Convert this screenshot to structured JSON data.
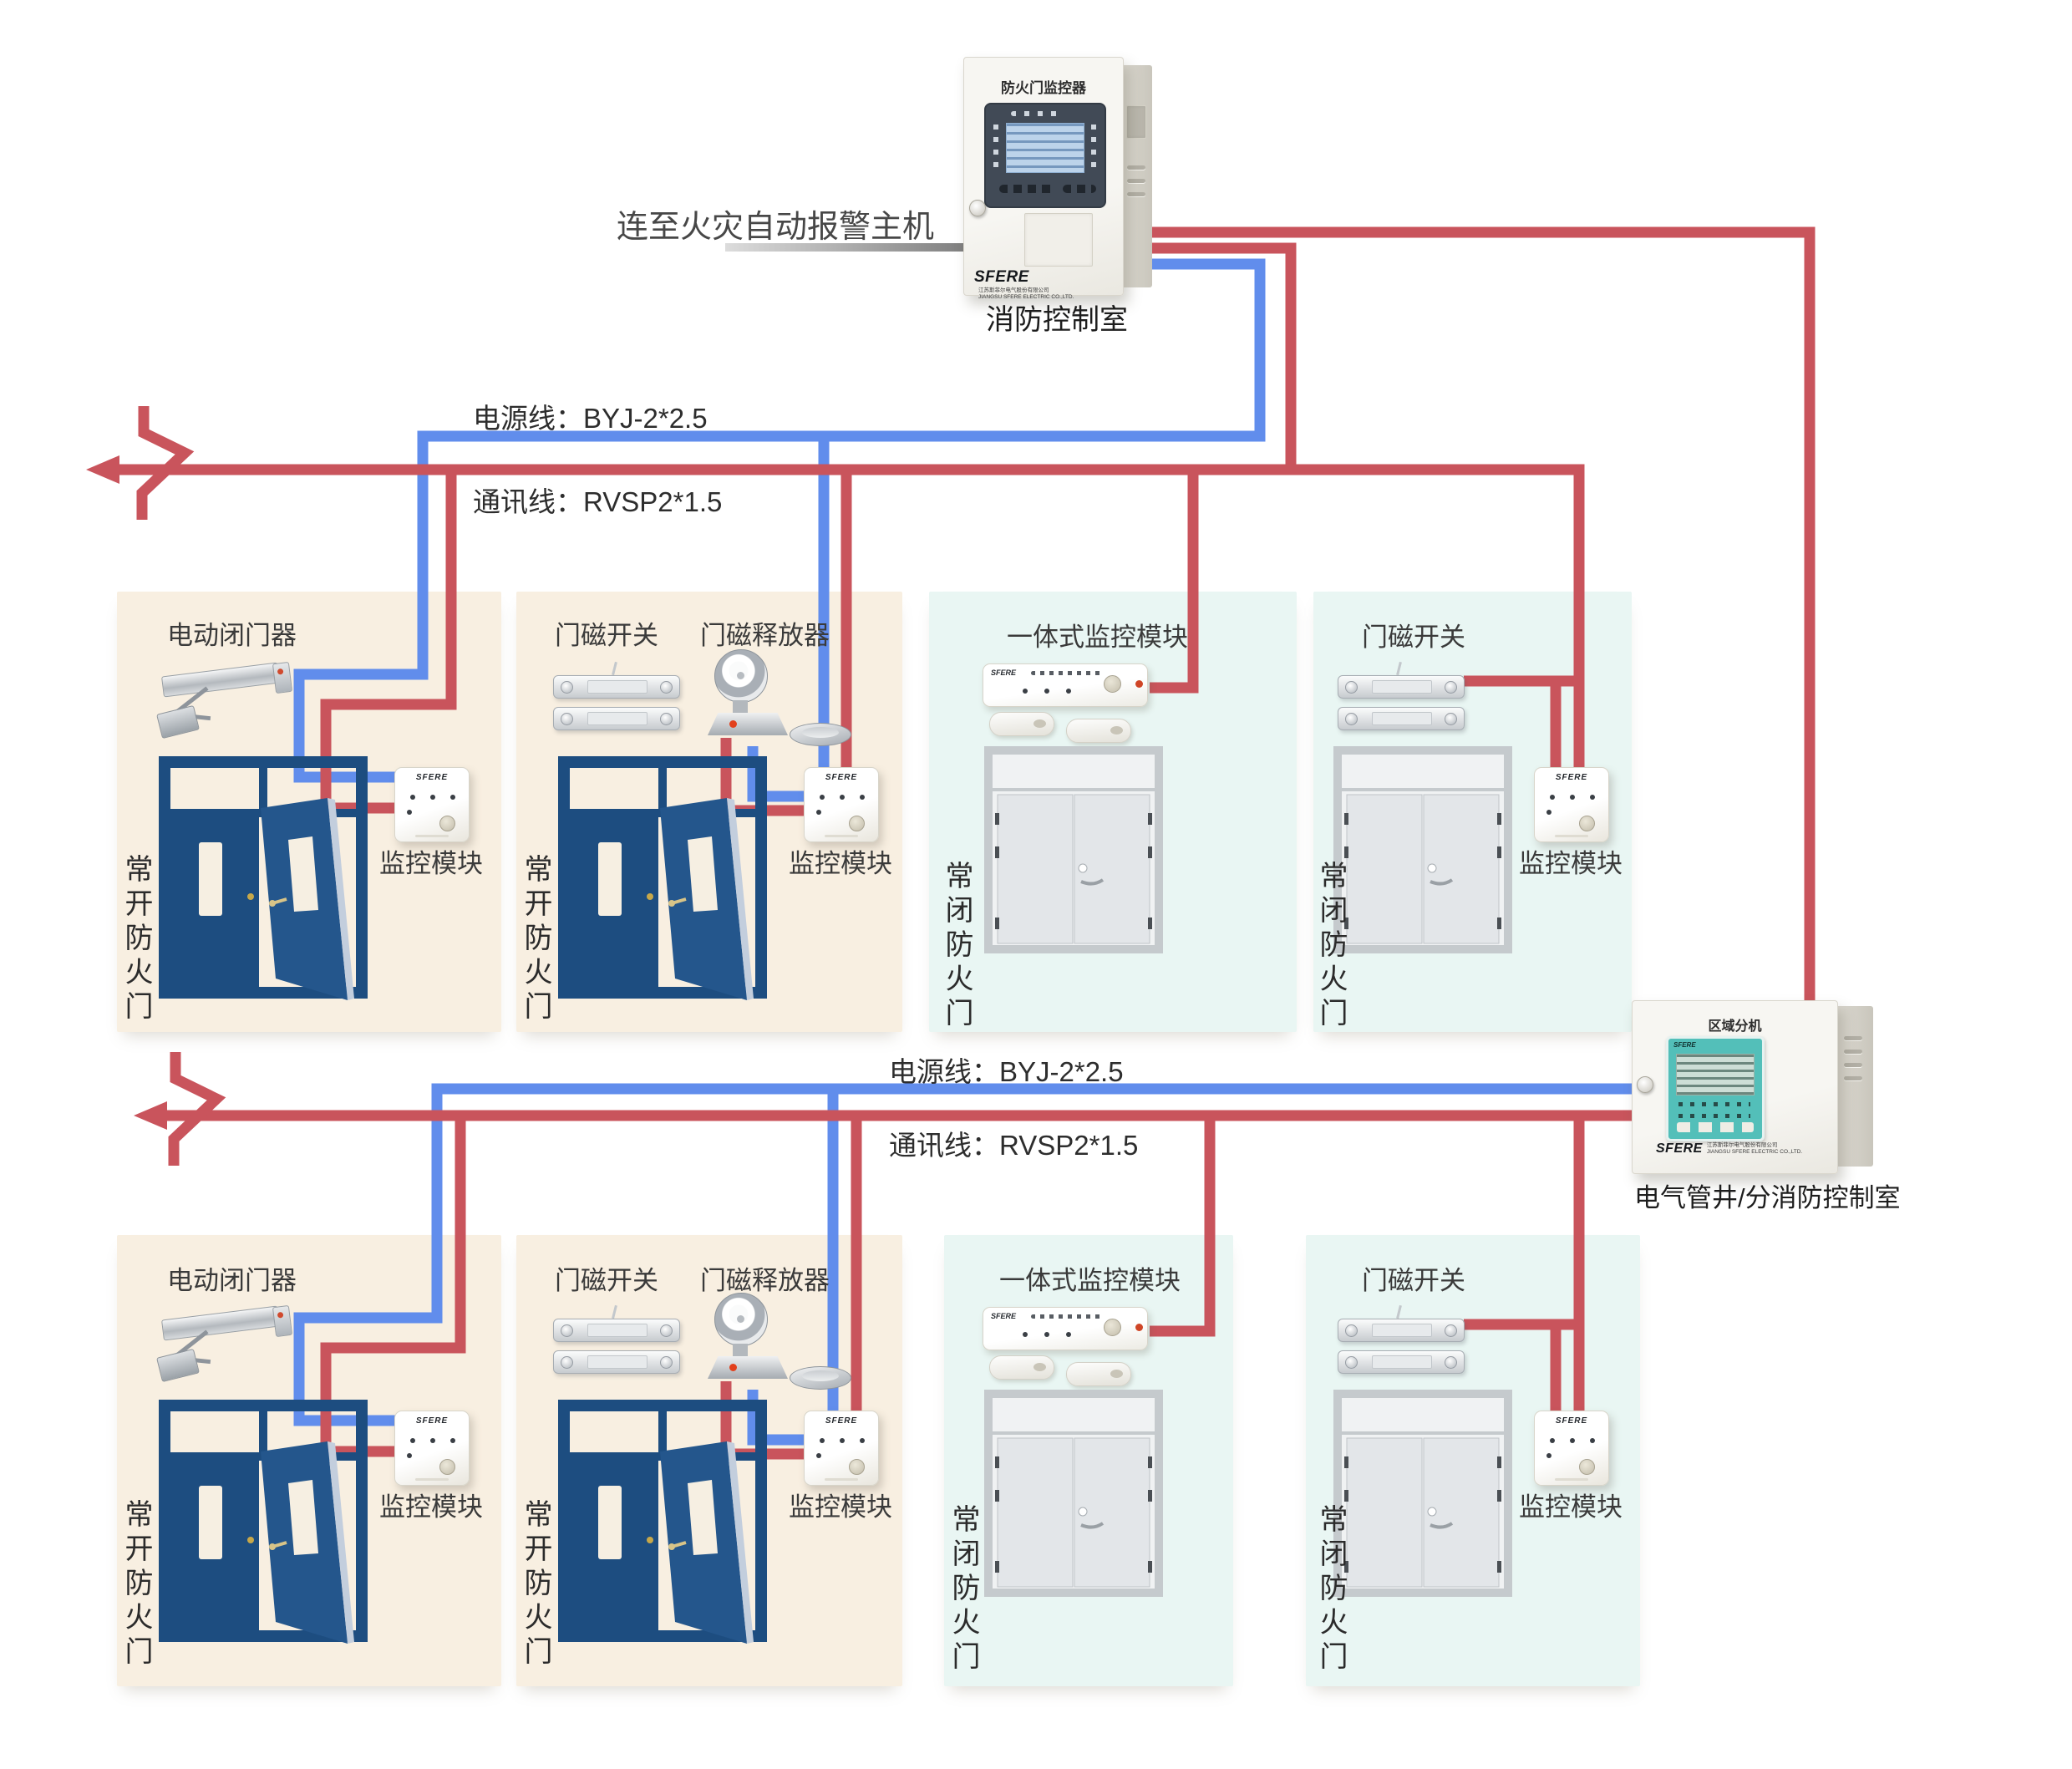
{
  "brand": {
    "name": "SFERE",
    "company_cn": "江苏斯菲尔电气股份有限公司",
    "company_en": "JIANGSU SFERE ELECTRIC CO.,LTD."
  },
  "colors": {
    "power_wire_blue": "#618dec",
    "comm_wire_red": "#c9545c",
    "panel_warm_beige": "#f8efe1",
    "panel_cool_cyan": "#e9f6f3",
    "door_navy": "#1d4d80",
    "regional_display_teal": "#53bfb9"
  },
  "top": {
    "link_label": "连至火灾自动报警主机",
    "controller_title": "防火门监控器",
    "controller_caption": "消防控制室"
  },
  "buses": {
    "power_label": "电源线：BYJ-2*2.5",
    "comm_label": "通讯线：RVSP2*1.5"
  },
  "regional": {
    "title": "区域分机",
    "caption": "电气管井/分消防控制室"
  },
  "panels": {
    "closer": {
      "title": "电动闭门器",
      "door_label": "常开防火门",
      "module_label": "监控模块"
    },
    "switch_release": {
      "switch_title": "门磁开关",
      "release_title": "门磁释放器",
      "door_label": "常开防火门",
      "module_label": "监控模块"
    },
    "integrated": {
      "title": "一体式监控模块",
      "door_label": "常闭防火门"
    },
    "switch": {
      "title": "门磁开关",
      "door_label": "常闭防火门",
      "module_label": "监控模块"
    }
  }
}
